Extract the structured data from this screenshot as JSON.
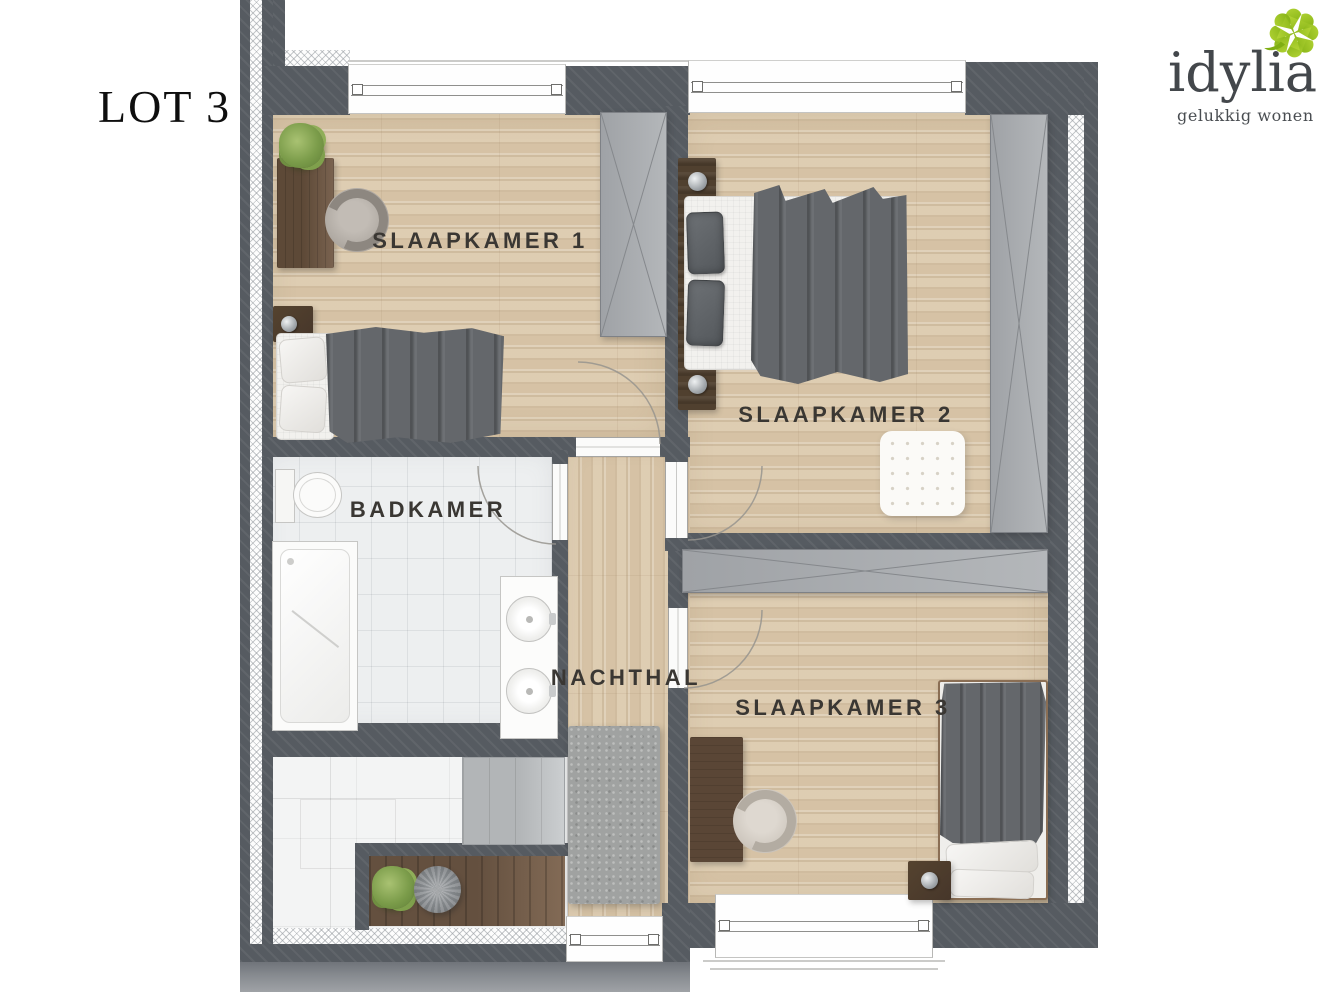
{
  "header": {
    "lot_label": "LOT 3"
  },
  "brand": {
    "name": "idylia",
    "tagline": "gelukkig wonen",
    "clover_green": "#94c11f",
    "text_color": "#43474b"
  },
  "rooms": [
    {
      "id": "slaapkamer-1",
      "label": "SLAAPKAMER 1"
    },
    {
      "id": "slaapkamer-2",
      "label": "SLAAPKAMER 2"
    },
    {
      "id": "badkamer",
      "label": "BADKAMER"
    },
    {
      "id": "nachthal",
      "label": "NACHTHAL"
    },
    {
      "id": "slaapkamer-3",
      "label": "SLAAPKAMER 3"
    }
  ],
  "palette": {
    "wall": "#565b61",
    "insulation_hatch": "#fdfdfd",
    "wood_floor": "#d9c7ab",
    "tile_floor": "#edeff0",
    "stair_floor": "#f3f4f4",
    "furniture_gray": "#a9acb0",
    "textile_gray": "#64676b",
    "wood_furniture": "#5f4a38",
    "label_text": "#3a3733"
  }
}
